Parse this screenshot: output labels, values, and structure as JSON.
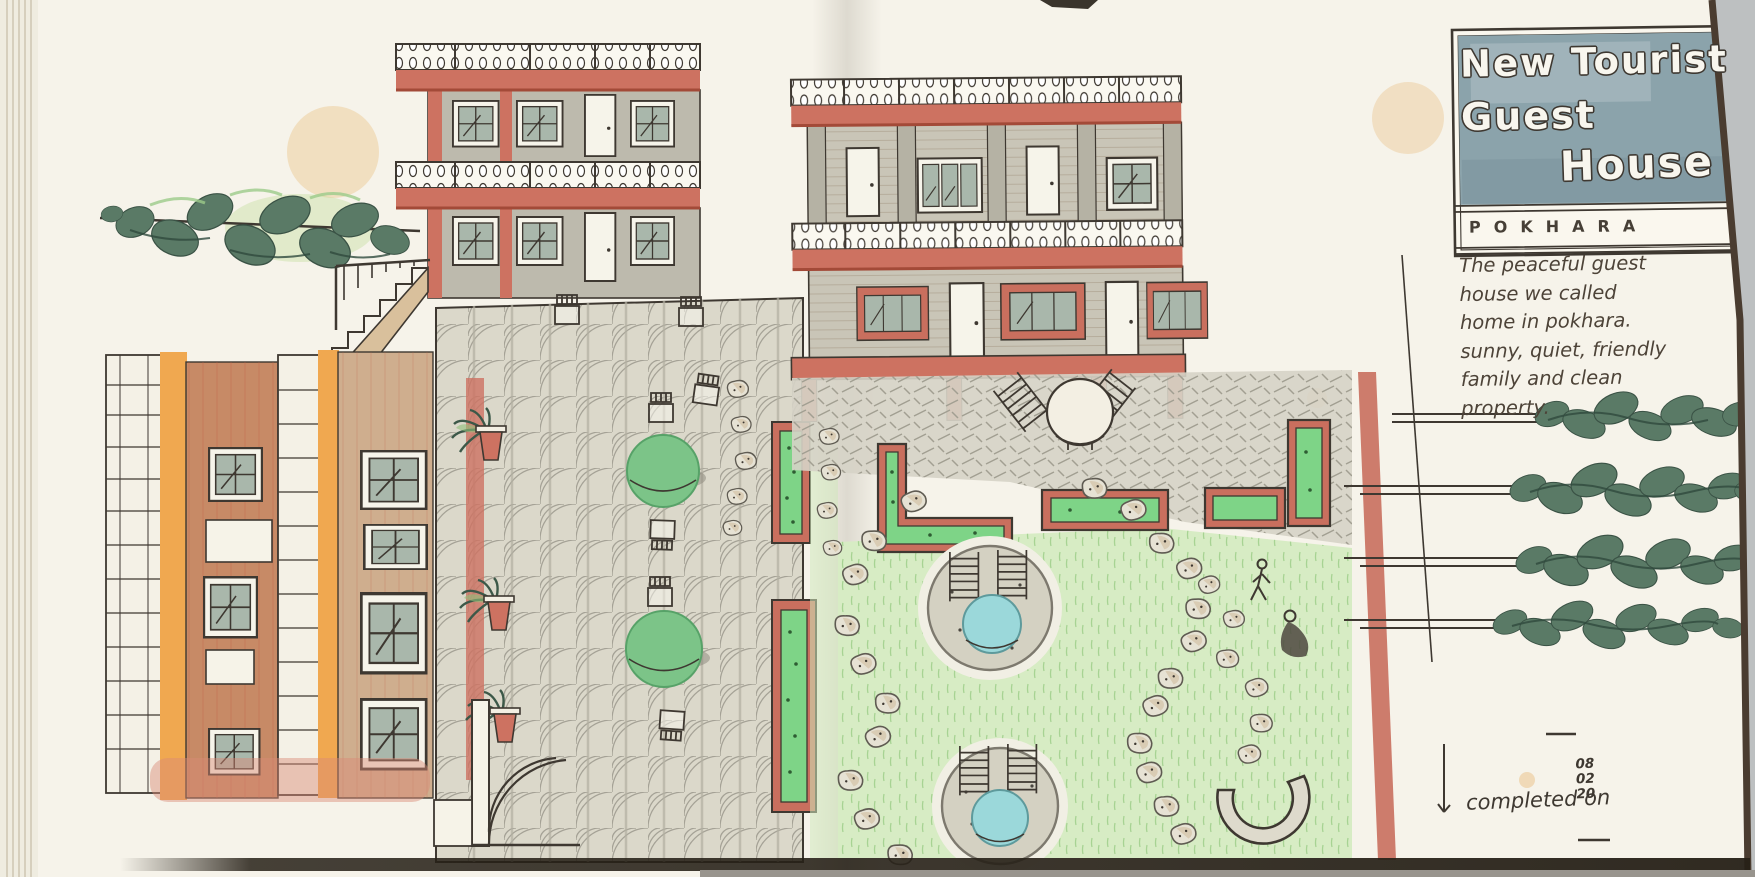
{
  "sign": {
    "line1": "New Tourist",
    "line2": "Guest",
    "line3": "House",
    "subtitle": "POKHARA"
  },
  "note": {
    "lines": [
      "The peaceful guest",
      "house we called",
      "home in pokhara.",
      "sunny, quiet, friendly",
      "family and clean",
      "property."
    ]
  },
  "completion": {
    "label": "completed on",
    "date": [
      "08",
      "02",
      "20"
    ]
  },
  "palette": {
    "paper": "#f6f3ea",
    "ink": "#3e3831",
    "sign_blue": "#8ba3ab",
    "accent_red": "#cd7261",
    "accent_orange": "#f0a850",
    "terracotta": "#c78a66",
    "wall_gray": "#bdbaad",
    "glass_green": "#a9b7ab",
    "lawn_green": "#d7ecc4",
    "table_green": "#7cc488",
    "pool_blue": "#9bd8da",
    "planter_green": "#7ed487",
    "tree_green": "#5a7a66"
  }
}
